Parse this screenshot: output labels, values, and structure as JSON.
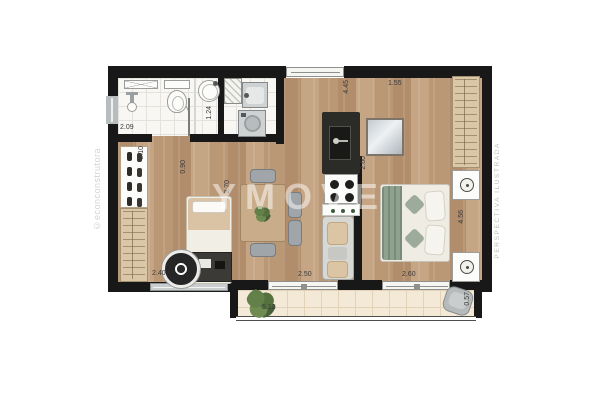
{
  "watermarks": {
    "left": "©econconstrutora",
    "center": "YMOVE",
    "right": "PERSPECTIVA ILUSTRADA"
  },
  "dimensions": {
    "bathroom_width": "2.09",
    "bathroom_depth": "1.24",
    "closet_wall": "3.10",
    "hall_opening": "0.90",
    "bedroom2_depth": "2.70",
    "bedroom2_width": "2.40",
    "living_length": "4.45",
    "suite_entry": "1.55",
    "suite_width": "2.60",
    "balcony_door_living": "2.50",
    "balcony_door_suite": "2.60",
    "suite_length": "4.56",
    "balcony_width": "5.12",
    "balcony_depth": "0.57"
  },
  "palette": {
    "wall": "#181818",
    "wood": "#c2a183",
    "balcony": "#f3e9d6",
    "counter_dark": "#2b2b28",
    "dim_text": "#3a3a3a"
  },
  "icons": {
    "toilet_icon": "css-oval-with-tank",
    "sink_icon": "css-pedestal-circle",
    "round_basin_icon": "css-double-circle",
    "washer_icon": "css-square-with-ring",
    "laundry_tank_icon": "css-inset-square",
    "stove_icon": "css-four-burner-dots",
    "kitchen_sink_icon": "css-dark-inset",
    "lamp_icon": "css-circle-dot",
    "plant_icon": "css-green-blob-cluster",
    "rug_icon": "css-concentric-circle",
    "shoe_rack_icon": "css-paired-ovals",
    "hanger_rail_icon": "css-line-pattern"
  }
}
